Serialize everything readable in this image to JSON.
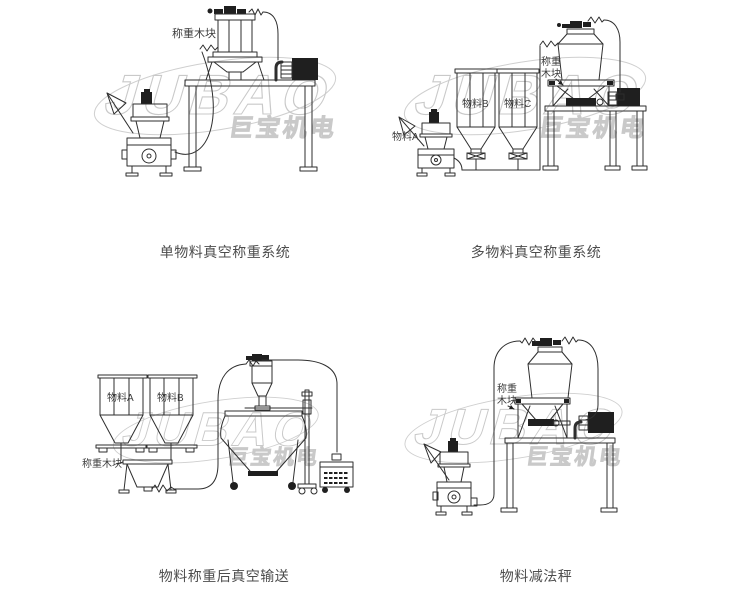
{
  "watermark": {
    "latin": "JUBAO",
    "cjk": "巨宝机电"
  },
  "colors": {
    "line": "#2e2e2e",
    "watermark": "#c9c9c9",
    "caption": "#4d4d4d"
  },
  "figures": {
    "fig1": {
      "caption": "单物料真空称重系统",
      "labels": {
        "module": "称重木块"
      }
    },
    "fig2": {
      "caption": "多物料真空称重系统",
      "labels": {
        "material_a": "物料A",
        "material_b": "物料B",
        "material_c": "物料C",
        "module_line1": "称重",
        "module_line2": "木块"
      }
    },
    "fig3": {
      "caption": "物料称重后真空输送",
      "labels": {
        "material_a": "物料A",
        "material_b": "物料B",
        "module": "称重木块"
      }
    },
    "fig4": {
      "caption": "物料减法秤",
      "labels": {
        "module_line1": "称重",
        "module_line2": "木块"
      }
    }
  }
}
